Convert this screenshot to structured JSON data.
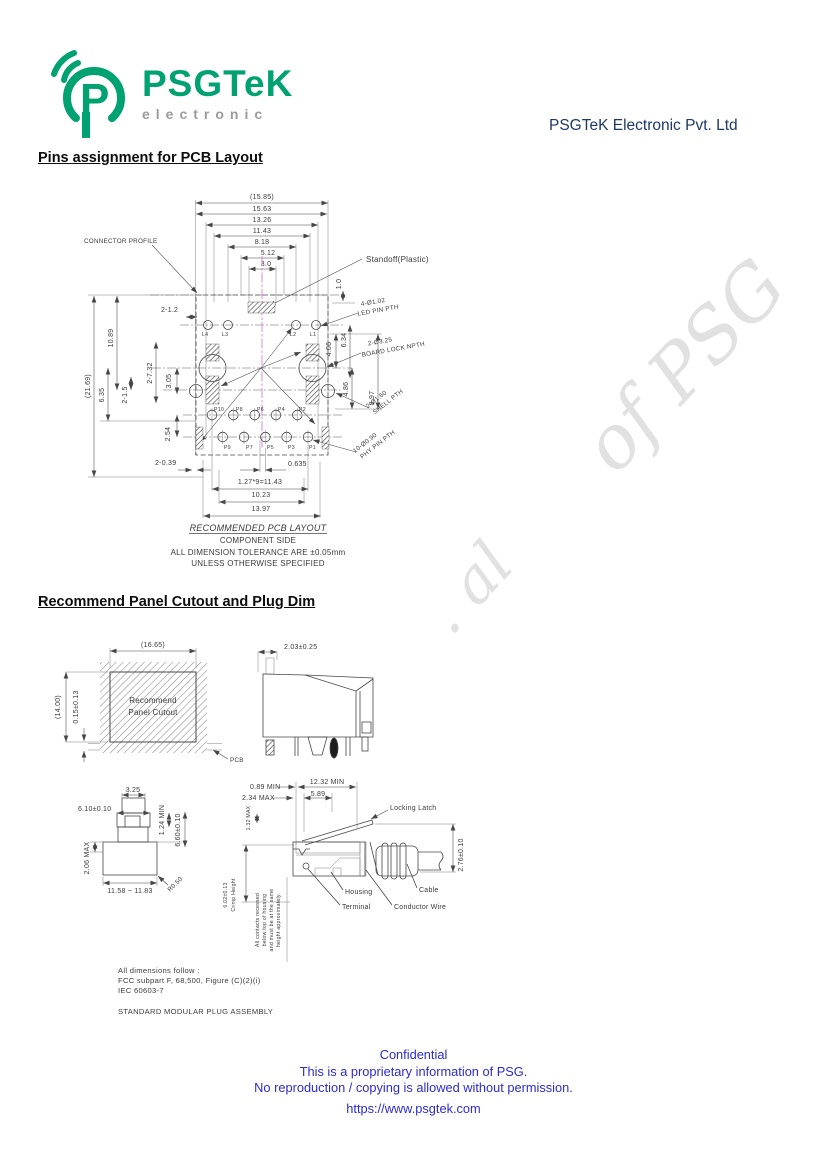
{
  "header": {
    "logo_text": "PSGTeK",
    "logo_sub": "electronic",
    "company": "PSGTeK Electronic Pvt. Ltd"
  },
  "sections": {
    "s1": "Pins assignment for PCB Layout",
    "s2": "Recommend Panel Cutout and Plug Dim"
  },
  "watermark": {
    "f1": ". al",
    "f2": "of PSG"
  },
  "colors": {
    "brand_green": "#00a271",
    "logo_gray": "#9b9b9b",
    "navy": "#1f3864",
    "footer_blue": "#2b2bd1",
    "centerline_magenta": "#e07cd9"
  },
  "pcb": {
    "profile_label": "CONNECTOR PROFILE",
    "standoff_label": "Standoff(Plastic)",
    "dims_top": [
      "(15.85)",
      "15.63",
      "13.26",
      "11.43",
      "8.18",
      "5.12",
      "3.0"
    ],
    "left": {
      "total": "(21.69)",
      "a": "10.89",
      "b": "6.35",
      "c": "2-1.5",
      "d": "2-7.32",
      "e": "3.05",
      "f": "2.54",
      "g": "2-1.2",
      "h": "2-0.39"
    },
    "right": {
      "a": "1.0",
      "b": "6.34",
      "c": "4.06",
      "d": "4.86",
      "e": "8.97"
    },
    "bottom": {
      "a": "0.635",
      "b": "1.27*9=11.43",
      "c": "10.23",
      "d": "13.97"
    },
    "callouts": {
      "led1": "4-Ø1.02",
      "led2": "LED PIN PTH",
      "lock1": "2-Ø3.25",
      "lock2": "BOARD LOCK NPTH",
      "shell1": "2-Ø1.60",
      "shell2": "SHELL PTH",
      "phy1": "10-Ø0.90",
      "phy2": "PHY PIN PTH"
    },
    "pins_led": [
      "L4",
      "L3",
      "L2",
      "L1"
    ],
    "pins_even": [
      "P10",
      "P8",
      "P6",
      "P4",
      "P2"
    ],
    "pins_odd": [
      "P9",
      "P7",
      "P5",
      "P3",
      "P1"
    ],
    "caption": [
      "RECOMMENDED PCB LAYOUT",
      "COMPONENT SIDE",
      "ALL DIMENSION TOLERANCE ARE ±0.05mm",
      "UNLESS OTHERWISE SPECIFIED"
    ]
  },
  "panel": {
    "w": "(16.65)",
    "h": "(14.00)",
    "off": "0.15±0.13",
    "line1": "Recommend",
    "line2": "Panel Cutout",
    "pcb": "PCB",
    "side_dim": "2.03±0.25"
  },
  "plug_front": {
    "top": "3.25",
    "latch": "6.10±0.10",
    "min": "1.24 MIN",
    "h": "6.60±0.10",
    "max": "2.06 MAX",
    "w": "11.58 ~ 11.83",
    "r": "R0.50"
  },
  "plug_side": {
    "d1": "0.89 MIN",
    "d2": "2.34 MAX",
    "d3": "12.32 MIN",
    "d4": "5.89",
    "d5": "1.32 MAX",
    "d6": "2.76±0.10",
    "crimp1": "6.02±0.13",
    "crimp2": "Crimp Height",
    "latch": "Locking Latch",
    "housing": "Housing",
    "terminal": "Terminal",
    "wire": "Conductor Wire",
    "cable": "Cable",
    "note": [
      "All contacts recessed",
      "below top of housing",
      "and must be at the same",
      "height approximately."
    ]
  },
  "notes": {
    "l1": "All dimensions follow :",
    "l2": "FCC subpart F, 68,500, Figure (C)(2)(i)",
    "l3": "IEC 60603-7",
    "l4": "STANDARD MODULAR PLUG ASSEMBLY"
  },
  "footer": {
    "l1": "Confidential",
    "l2": "This is a proprietary information of PSG.",
    "l3": "No reproduction / copying is allowed without permission.",
    "url": "https://www.psgtek.com"
  }
}
